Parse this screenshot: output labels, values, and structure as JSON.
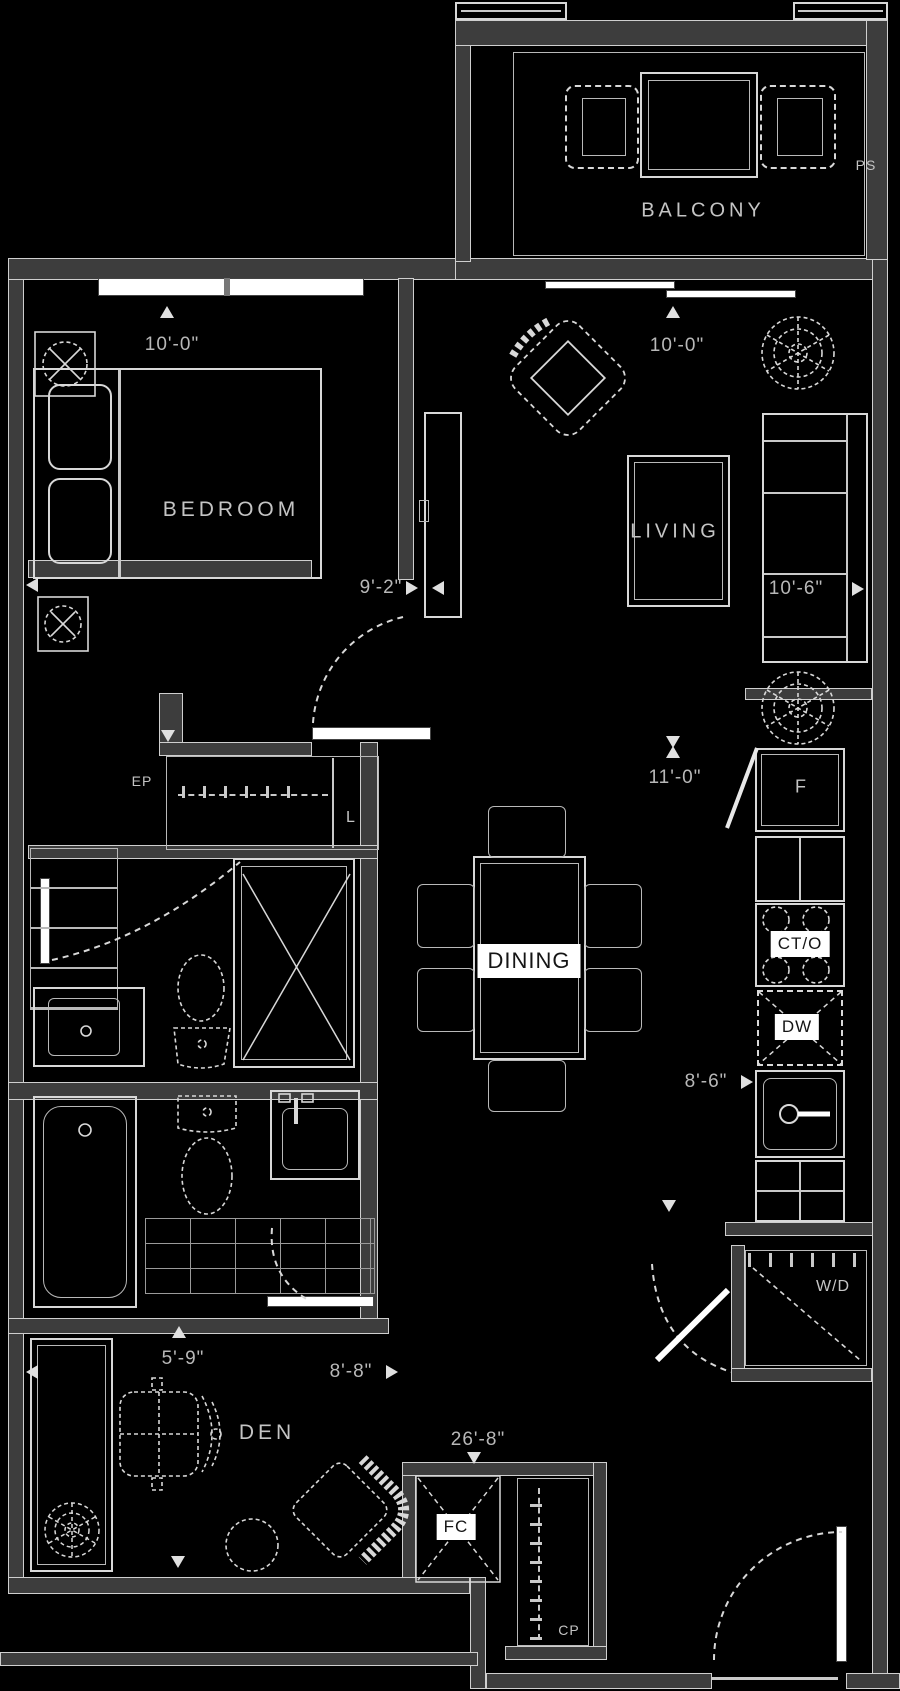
{
  "plan": {
    "rooms": {
      "balcony": "BALCONY",
      "bedroom": "BEDROOM",
      "living": "LIVING",
      "dining": "DINING",
      "den": "DEN"
    },
    "appliances": {
      "fridge": "F",
      "cooktop_oven": "CT/O",
      "dishwasher": "DW",
      "washer_dryer": "W/D",
      "fan_coil": "FC"
    },
    "closets": {
      "linen": "L",
      "electrical_panel": "EP",
      "coat_closet": "CP",
      "privacy_screen": "PS"
    },
    "dimensions": {
      "bedroom_width": "10'-0\"",
      "bedroom_depth": "9'-2\"",
      "living_width": "10'-0\"",
      "living_depth": "10'-6\"",
      "kitchen_length": "11'-0\"",
      "kitchen_width": "8'-6\"",
      "den_width": "5'-9\"",
      "den_length": "8'-8\"",
      "unit_length": "26'-8\""
    },
    "colors": {
      "background": "#000000",
      "lines": "#d8d8d8",
      "wall_fill": "#3d3d3d",
      "dim_text": "#b8b8b8",
      "room_text": "#c4c4c4",
      "label_bg": "#ffffff",
      "label_text": "#151515"
    }
  }
}
